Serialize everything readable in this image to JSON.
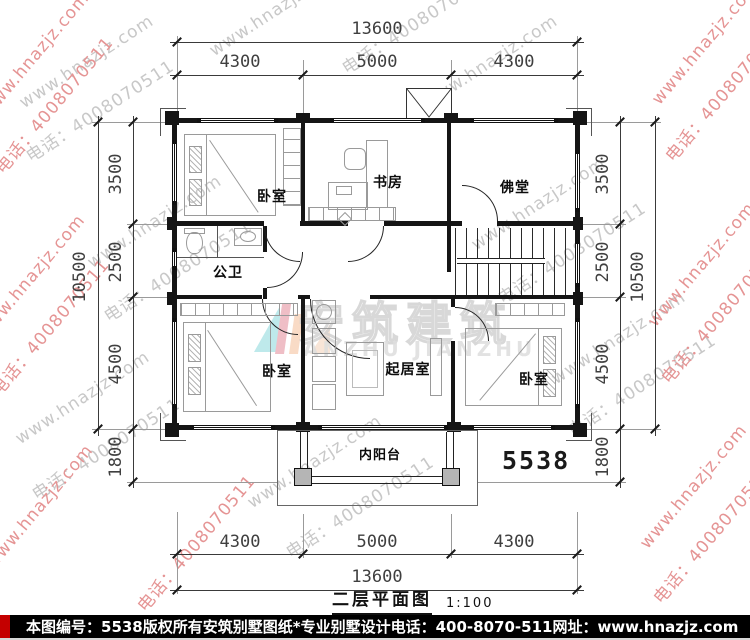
{
  "title": {
    "text": "二层平面图",
    "scale": "1:100"
  },
  "plan_number": "5538",
  "rooms": {
    "bedroom_top_left": "卧室",
    "study": "书房",
    "buddhist_hall": "佛堂",
    "bathroom": "公卫",
    "bedroom_bottom_left": "卧室",
    "living_room": "起居室",
    "bedroom_bottom_right": "卧室",
    "balcony": "内阳台"
  },
  "dims": {
    "top_total": "13600",
    "top_segments": [
      "4300",
      "5000",
      "4300"
    ],
    "left_segments": [
      "3500",
      "2500",
      "4500",
      "1800"
    ],
    "left_total": "10500",
    "right_segments": [
      "3500",
      "2500",
      "4500",
      "1800"
    ],
    "right_total": "10500",
    "bottom_segments": [
      "4300",
      "5000",
      "4300"
    ],
    "bottom_total": "13600"
  },
  "watermark": {
    "url": "www.hnazjz.com",
    "phone": "电话：4008070511",
    "brand": "安筑建筑",
    "brand_en": "ANZHU JIANZHU"
  },
  "footer": {
    "plan_no": "本图编号：5538",
    "copyright": "版权所有",
    "company": "安筑别墅图纸*专业别墅设计",
    "phone": "电话：400-8070-511",
    "website": "网址：www.hnazjz.com"
  },
  "colors": {
    "footer_bg": "#000000",
    "footer_accent": "#c40000",
    "wall": "#151515",
    "watermark_gray": "#c8c8c8",
    "watermark_pink": "#e59494"
  }
}
